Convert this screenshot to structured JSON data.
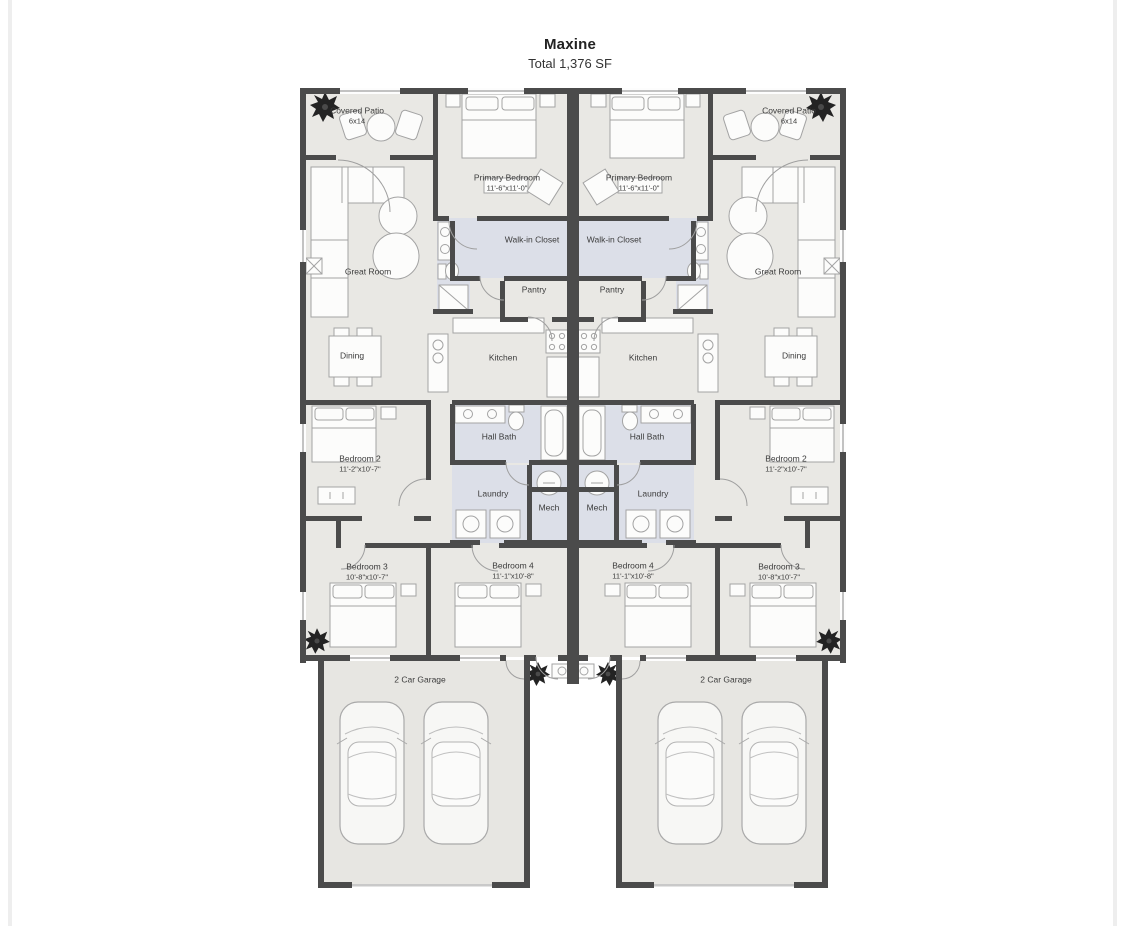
{
  "title": "Maxine",
  "subtitle": "Total 1,376 SF",
  "rooms": {
    "covered_patio": {
      "label": "Covered Patio",
      "dims": "6x14"
    },
    "primary_bedroom": {
      "label": "Primary Bedroom",
      "dims": "11'-6\"x11'-0\""
    },
    "great_room": {
      "label": "Great Room"
    },
    "walk_in_closet": {
      "label": "Walk-in Closet"
    },
    "pantry": {
      "label": "Pantry"
    },
    "dining": {
      "label": "Dining"
    },
    "kitchen": {
      "label": "Kitchen"
    },
    "hall_bath": {
      "label": "Hall Bath"
    },
    "laundry": {
      "label": "Laundry"
    },
    "mech": {
      "label": "Mech"
    },
    "bedroom_2": {
      "label": "Bedroom 2",
      "dims": "11'-2\"x10'-7\""
    },
    "bedroom_3": {
      "label": "Bedroom 3",
      "dims": "10'-8\"x10'-7\""
    },
    "bedroom_4": {
      "label": "Bedroom 4",
      "dims": "11'-1\"x10'-8\""
    },
    "garage": {
      "label": "2 Car Garage"
    }
  },
  "units": [
    "left",
    "right"
  ],
  "colors": {
    "floor": "#e9e8e4",
    "garage_floor": "#e7e6e2",
    "wet_area": "#dcdfe8",
    "wall": "#4b4b4b",
    "furniture_outline": "#a3a3a3",
    "plant": "#232323",
    "label_text": "#3b3b3b"
  }
}
